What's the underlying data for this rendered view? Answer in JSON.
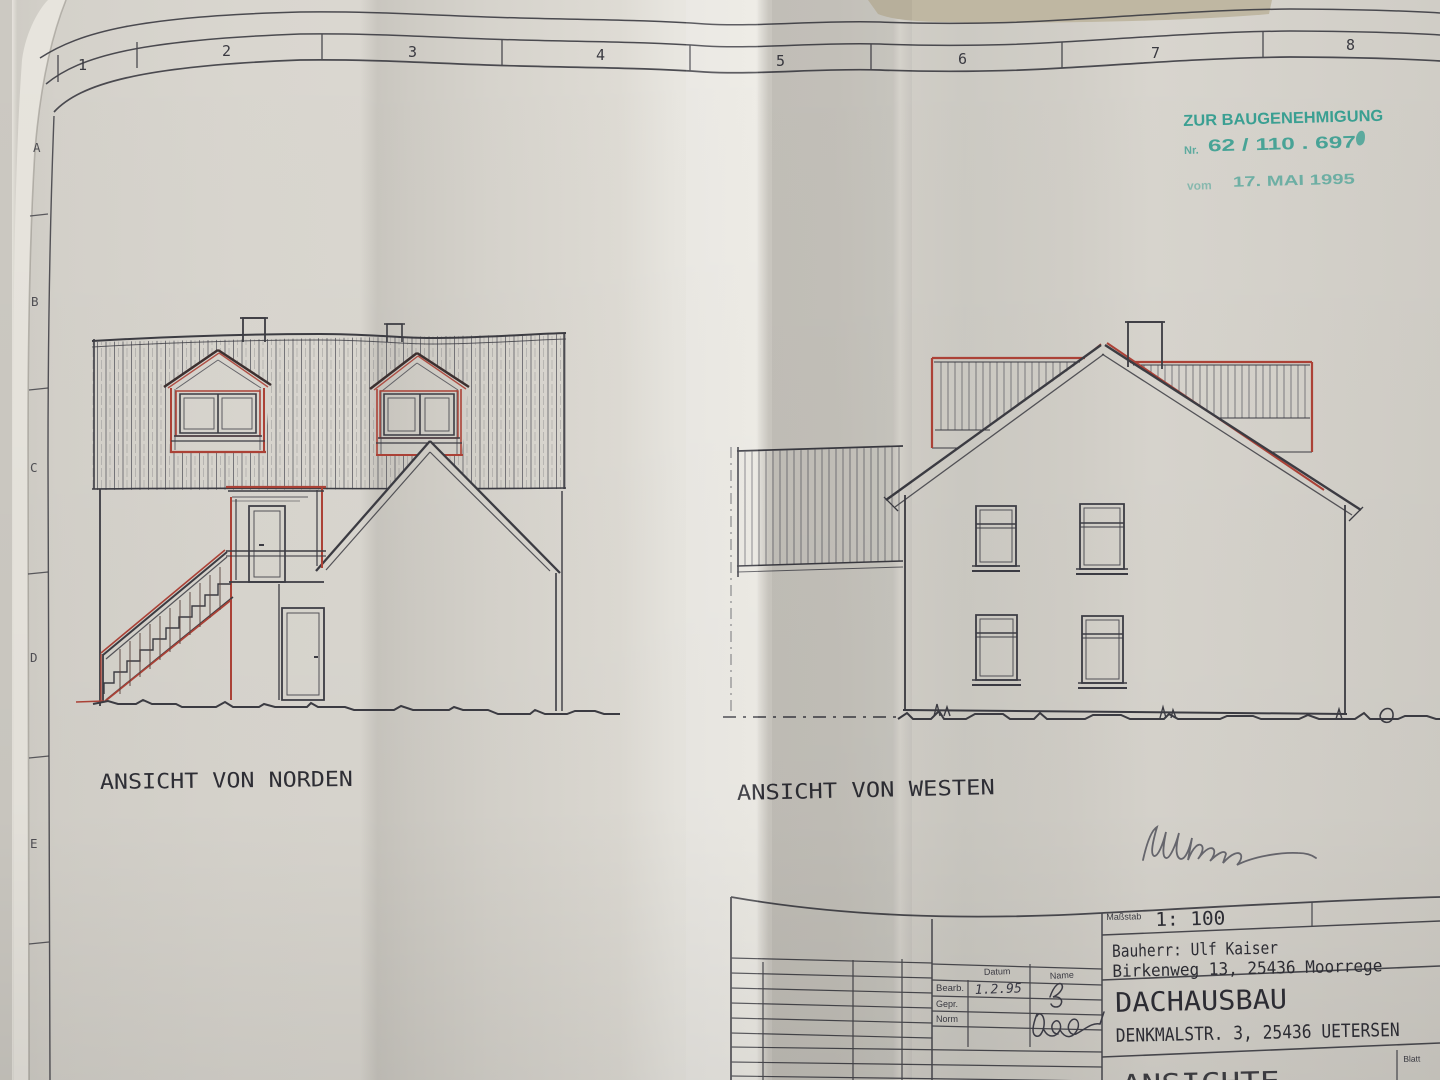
{
  "colors": {
    "paper": "#d6d3cc",
    "ink": "#34343a",
    "red_marking": "#ad4237",
    "stamp_teal": "#2a9a8c",
    "pencil": "#55555e"
  },
  "ruler": {
    "numbers": [
      "1",
      "2",
      "3",
      "4",
      "5",
      "6",
      "7",
      "8"
    ]
  },
  "margin": {
    "letters": [
      "A",
      "B",
      "C",
      "D",
      "E"
    ]
  },
  "stamp": {
    "line1": "ZUR BAUGENEHMIGUNG",
    "nr_label": "Nr.",
    "nr_value": "62 / 110 . 697",
    "date_label": "vom",
    "date_value": "17. MAI 1995"
  },
  "views": {
    "north_label": "ANSICHT VON NORDEN",
    "west_label": "ANSICHT VON WESTEN"
  },
  "title_block": {
    "massstab_label": "Maßstab",
    "massstab_value": "1: 100",
    "bauherr": "Bauherr: Ulf Kaiser",
    "bauherr_address": "Birkenweg 13,  25436 Moorrege",
    "project": "DACHAUSBAU",
    "site_address": "DENKMALSTR. 3,  25436 UETERSEN",
    "blatt_label": "Blatt",
    "partial_bottom_text": "ANSICHTE",
    "columns": {
      "datum": "Datum",
      "name": "Name"
    },
    "rows": [
      {
        "label": "Bearb.",
        "datum": "1.2.95",
        "name": ""
      },
      {
        "label": "Gepr.",
        "datum": "",
        "name": ""
      },
      {
        "label": "Norm",
        "datum": "",
        "name": ""
      }
    ]
  }
}
